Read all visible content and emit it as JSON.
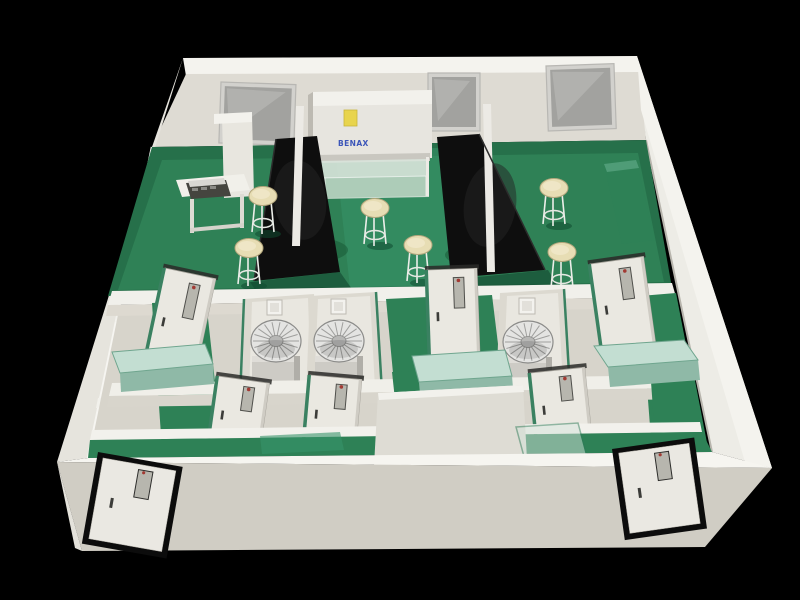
{
  "scene": {
    "description": "3D cutaway rendering of a laboratory floor plan viewed from above-front",
    "background_color": "#000000",
    "palette": {
      "floor_green": "#2e8156",
      "floor_green_dark": "#1d6243",
      "wall_white": "#e8e6df",
      "wall_top_bright": "#f2f1ec",
      "wall_shadow": "#cfccc3",
      "bench_black": "#0e0e0e",
      "bench_seafoam": "#c3ded2",
      "stool_seat": "#e7ddb4",
      "metal_silver": "#d8d8d6",
      "door_white": "#eae8e1",
      "door_frame_green": "#3a8161",
      "entry_door_frame": "#0c0c0c",
      "window_glass": "#a2a29f",
      "logo_blue": "#2b47b5",
      "sticker_yellow": "#e8d44d",
      "door_window_dot_red": "#a23a33"
    },
    "cabinet": {
      "brand_text": "BENAX",
      "sticker_color": "#e8d44d"
    },
    "counts": {
      "back_windows": 3,
      "stools": 6,
      "turbine_units": 3,
      "interior_doors": 6,
      "entry_doors": 2,
      "black_lab_islands": 2,
      "seafoam_benches": 3,
      "wall_switch_boxes": 3
    },
    "windows": [
      {
        "x": 221,
        "y": 82,
        "w": 75,
        "h": 61,
        "rot": 2
      },
      {
        "x": 428,
        "y": 73,
        "w": 52,
        "h": 58,
        "rot": 0
      },
      {
        "x": 546,
        "y": 66,
        "w": 68,
        "h": 65,
        "rot": -2
      }
    ],
    "stools": [
      {
        "cx": 263,
        "cy": 196
      },
      {
        "cx": 249,
        "cy": 248
      },
      {
        "cx": 375,
        "cy": 208
      },
      {
        "cx": 418,
        "cy": 245
      },
      {
        "cx": 554,
        "cy": 188
      },
      {
        "cx": 562,
        "cy": 252
      }
    ],
    "turbines": [
      {
        "cx": 276,
        "cy": 341
      },
      {
        "cx": 339,
        "cy": 341
      },
      {
        "cx": 528,
        "cy": 342
      }
    ],
    "wall_boxes": [
      {
        "x": 267,
        "y": 300,
        "s": 15
      },
      {
        "x": 331,
        "y": 299,
        "s": 15
      },
      {
        "x": 519,
        "y": 298,
        "s": 16
      }
    ],
    "interior_doors": [
      {
        "x": 165,
        "y": 268,
        "w": 52,
        "h": 97,
        "rot": 12
      },
      {
        "x": 427,
        "y": 270,
        "w": 50,
        "h": 85,
        "rot": -2
      },
      {
        "x": 590,
        "y": 264,
        "w": 54,
        "h": 87,
        "rot": -8
      },
      {
        "x": 218,
        "y": 376,
        "w": 52,
        "h": 67,
        "rot": 8
      },
      {
        "x": 310,
        "y": 375,
        "w": 52,
        "h": 68,
        "rot": 5
      },
      {
        "x": 530,
        "y": 373,
        "w": 55,
        "h": 68,
        "rot": -6
      }
    ],
    "entry_doors": [
      {
        "x": 98,
        "y": 452,
        "w": 86,
        "h": 93,
        "rot": 10
      },
      {
        "x": 612,
        "y": 449,
        "w": 83,
        "h": 92,
        "rot": -8
      }
    ],
    "benches": [
      {
        "name": "bench-left",
        "pts_top": "112,352 205,344 213,364 120,373",
        "pts_front": "120,373 213,364 214,384 121,392"
      },
      {
        "name": "bench-right",
        "pts_top": "594,346 684,340 698,360 608,367",
        "pts_front": "608,367 698,360 700,380 610,387"
      },
      {
        "name": "bench-center",
        "pts_top": "412,356 505,350 512,376 419,382",
        "pts_front": "419,382 512,376 513,388 420,394"
      }
    ]
  }
}
